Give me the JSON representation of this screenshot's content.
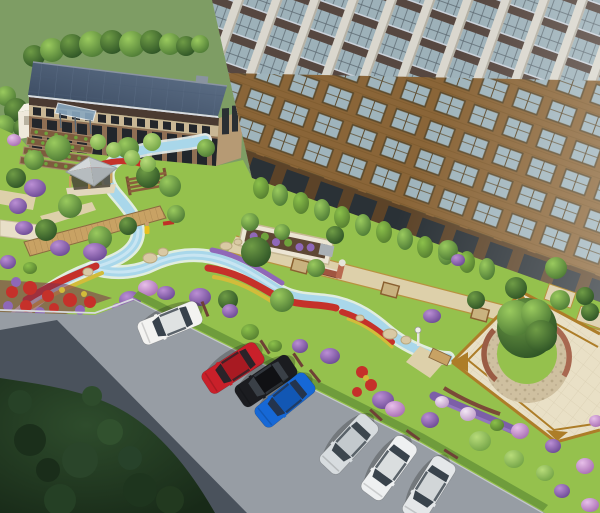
{
  "meta": {
    "kind": "architectural-landscape-rendering",
    "view": "aerial-perspective",
    "width_px": 600,
    "height_px": 513,
    "visible_text": "none"
  },
  "palette": {
    "field": "#7e9d64",
    "lawn": "#95c14d",
    "road": "#979da4",
    "roadShadow": "#4a525c",
    "stream": "#a9d7ea",
    "streamBank": "#e9f2f0",
    "pathTan": "#ddd0aa",
    "wood": "#c8a264",
    "plazaPav": "#e9e0c6",
    "plazaBorder": "#ad7d28",
    "seatWall": "#9a5c44",
    "flowerRed": "#c5312a",
    "flowerYellow": "#d2bc3a",
    "flowerPurple": "#8f68b8",
    "wheelStop": "#6e4136",
    "carWhite": "#f3f3f1",
    "carRed": "#c9202a",
    "carBlack": "#1b1c20",
    "carBlue": "#1668d6",
    "carSilver": "#d7dcdf",
    "carWhite2": "#eef0f1",
    "carGray": "#e4e7e9"
  },
  "scene": {
    "background": {
      "name": "grass-field-with-tree-line"
    },
    "buildings": [
      {
        "name": "office-building",
        "floors": 2,
        "roof": "dark-panel-flat-roof",
        "facade": "brick-with-dark-glazing",
        "roof_color": "#3b4a5e",
        "brick_color": "#8f6f54"
      },
      {
        "name": "residential-tower",
        "style": "high-rise",
        "facade_elements": [
          "white-pillars",
          "blue-gray-glazing",
          "dark-brown-spandrels",
          "golden-brick-frames"
        ],
        "pillar_color": "#dad7ce",
        "glass_color": "#9db1b9",
        "brick_color": "#8a6538"
      },
      {
        "name": "small-white-building",
        "color": "#efe9db"
      }
    ],
    "landscape_features": [
      "winding-blue-stream",
      "wooden-boardwalk",
      "gazebo-pavilion",
      "pergola",
      "community-garden-plots",
      "red-yellow-flower-borders",
      "purple-flower-shrubs",
      "boulders",
      "hedge-row-along-tower",
      "paved-walkway-with-inset-squares",
      "central-plaza-with-circular-lawn-and-tree",
      "curved-seat-walls",
      "lawn"
    ],
    "plaza": {
      "paving": "cream-stone",
      "border": "gold-banding",
      "center": "circular-lawn-with-large-tree",
      "seat_wall": "red-brown-curved-wall"
    },
    "parking": {
      "layout": "angled-parking-along-diagonal-road",
      "road_in_shadow": true,
      "tree_canopy_bottom_left": true,
      "cars": [
        {
          "name": "white-suv",
          "color": "#f3f3f1"
        },
        {
          "name": "red-car",
          "color": "#c9202a"
        },
        {
          "name": "black-car",
          "color": "#1b1c20"
        },
        {
          "name": "blue-car",
          "color": "#1668d6"
        },
        {
          "name": "silver-car",
          "color": "#d7dcdf"
        },
        {
          "name": "white-car",
          "color": "#eef0f1"
        },
        {
          "name": "light-gray-car",
          "color": "#e4e7e9"
        }
      ]
    }
  }
}
